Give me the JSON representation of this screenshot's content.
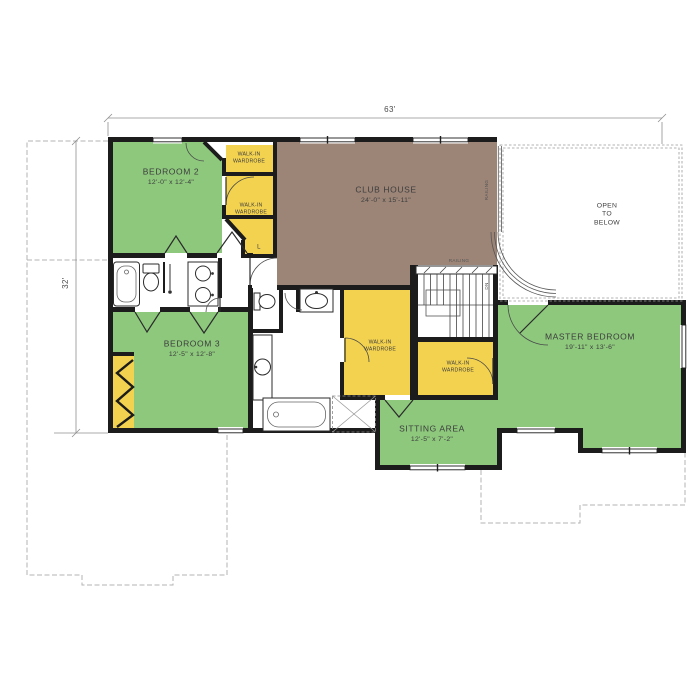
{
  "plan": {
    "dimensions": {
      "width": "63'",
      "height": "32'"
    },
    "rooms": {
      "bedroom2": {
        "name": "BEDROOM 2",
        "size": "12'-0\" x 12'-4\""
      },
      "club_house": {
        "name": "CLUB HOUSE",
        "size": "24'-0\" x 15'-11\""
      },
      "bedroom3": {
        "name": "BEDROOM 3",
        "size": "12'-5\" x 12'-8\""
      },
      "master_bedroom": {
        "name": "MASTER BEDROOM",
        "size": "19'-11\" x 13'-6\""
      },
      "sitting_area": {
        "name": "SITTING AREA",
        "size": "12'-5\" x 7'-2\""
      },
      "open_to_below": "OPEN\nTO\nBELOW",
      "walk_in_wardrobe": "WALK-IN\nWARDROBE",
      "linen_closet": "L"
    },
    "annotations": {
      "railing": "RAILING",
      "down": "DN"
    },
    "colors": {
      "room_green": "#8dc87d",
      "wardrobe_yellow": "#f3d24f",
      "club_brown": "#9c8577",
      "wall_black": "#1c1c1c"
    }
  }
}
